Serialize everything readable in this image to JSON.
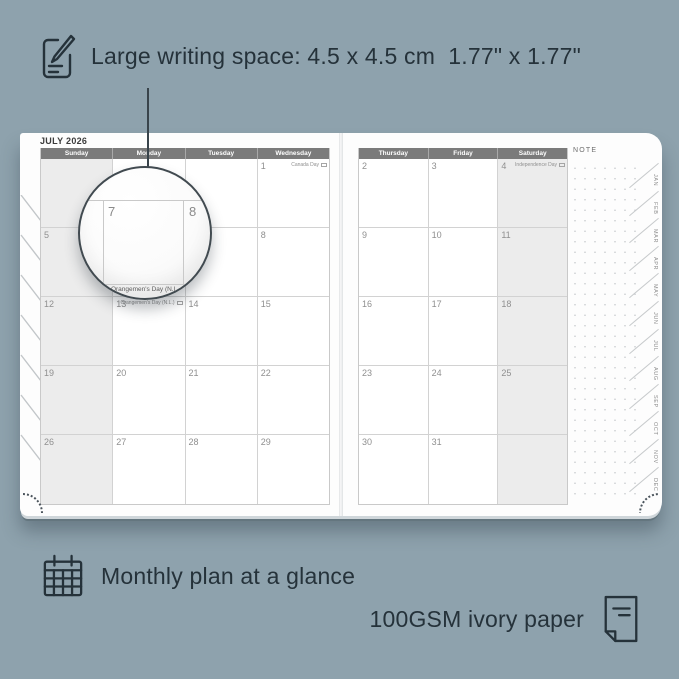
{
  "colors": {
    "background": "#8EA2AD",
    "ink": "#25323A",
    "header_bar": "#7B7B7B",
    "shaded_column": "#ECECEC",
    "grid_line": "#D2D2D2",
    "page": "#FDFDFD"
  },
  "annotations": {
    "top": {
      "icon": "pencil-note-icon",
      "text": "Large writing space: 4.5 x 4.5 cm  1.77\" x 1.77\""
    },
    "bottom_left": {
      "icon": "calendar-grid-icon",
      "text": "Monthly plan at a glance"
    },
    "bottom_right": {
      "icon": "paper-sheet-icon",
      "text": "100GSM ivory paper"
    }
  },
  "planner": {
    "month_title": "JULY 2026",
    "note_label": "NOTE",
    "left_page": {
      "day_headers": [
        "Sunday",
        "Monday",
        "Tuesday",
        "Wednesday"
      ],
      "weeks": [
        [
          {
            "day": "",
            "holiday": ""
          },
          {
            "day": "",
            "holiday": ""
          },
          {
            "day": "",
            "holiday": ""
          },
          {
            "day": "1",
            "holiday": "Canada Day"
          }
        ],
        [
          {
            "day": "5",
            "holiday": ""
          },
          {
            "day": "",
            "holiday": ""
          },
          {
            "day": "",
            "holiday": ""
          },
          {
            "day": "8",
            "holiday": ""
          }
        ],
        [
          {
            "day": "12",
            "holiday": ""
          },
          {
            "day": "13",
            "holiday": "Orangemen's Day (N.L.)"
          },
          {
            "day": "14",
            "holiday": ""
          },
          {
            "day": "15",
            "holiday": ""
          }
        ],
        [
          {
            "day": "19",
            "holiday": ""
          },
          {
            "day": "20",
            "holiday": ""
          },
          {
            "day": "21",
            "holiday": ""
          },
          {
            "day": "22",
            "holiday": ""
          }
        ],
        [
          {
            "day": "26",
            "holiday": ""
          },
          {
            "day": "27",
            "holiday": ""
          },
          {
            "day": "28",
            "holiday": ""
          },
          {
            "day": "29",
            "holiday": ""
          }
        ]
      ]
    },
    "right_page": {
      "day_headers": [
        "Thursday",
        "Friday",
        "Saturday"
      ],
      "weeks": [
        [
          {
            "day": "2",
            "holiday": ""
          },
          {
            "day": "3",
            "holiday": ""
          },
          {
            "day": "4",
            "holiday": "Independence Day"
          }
        ],
        [
          {
            "day": "9",
            "holiday": ""
          },
          {
            "day": "10",
            "holiday": ""
          },
          {
            "day": "11",
            "holiday": ""
          }
        ],
        [
          {
            "day": "16",
            "holiday": ""
          },
          {
            "day": "17",
            "holiday": ""
          },
          {
            "day": "18",
            "holiday": ""
          }
        ],
        [
          {
            "day": "23",
            "holiday": ""
          },
          {
            "day": "24",
            "holiday": ""
          },
          {
            "day": "25",
            "holiday": ""
          }
        ],
        [
          {
            "day": "30",
            "holiday": ""
          },
          {
            "day": "31",
            "holiday": ""
          },
          {
            "day": "",
            "holiday": ""
          }
        ]
      ]
    },
    "month_tabs": [
      "JAN",
      "FEB",
      "MAR",
      "APR",
      "MAY",
      "JUN",
      "JUL",
      "AUG",
      "SEP",
      "OCT",
      "NOV",
      "DEC"
    ],
    "magnifier": {
      "day_left": "7",
      "day_right": "8",
      "caption": "Orangemen's Day (N.L."
    }
  }
}
